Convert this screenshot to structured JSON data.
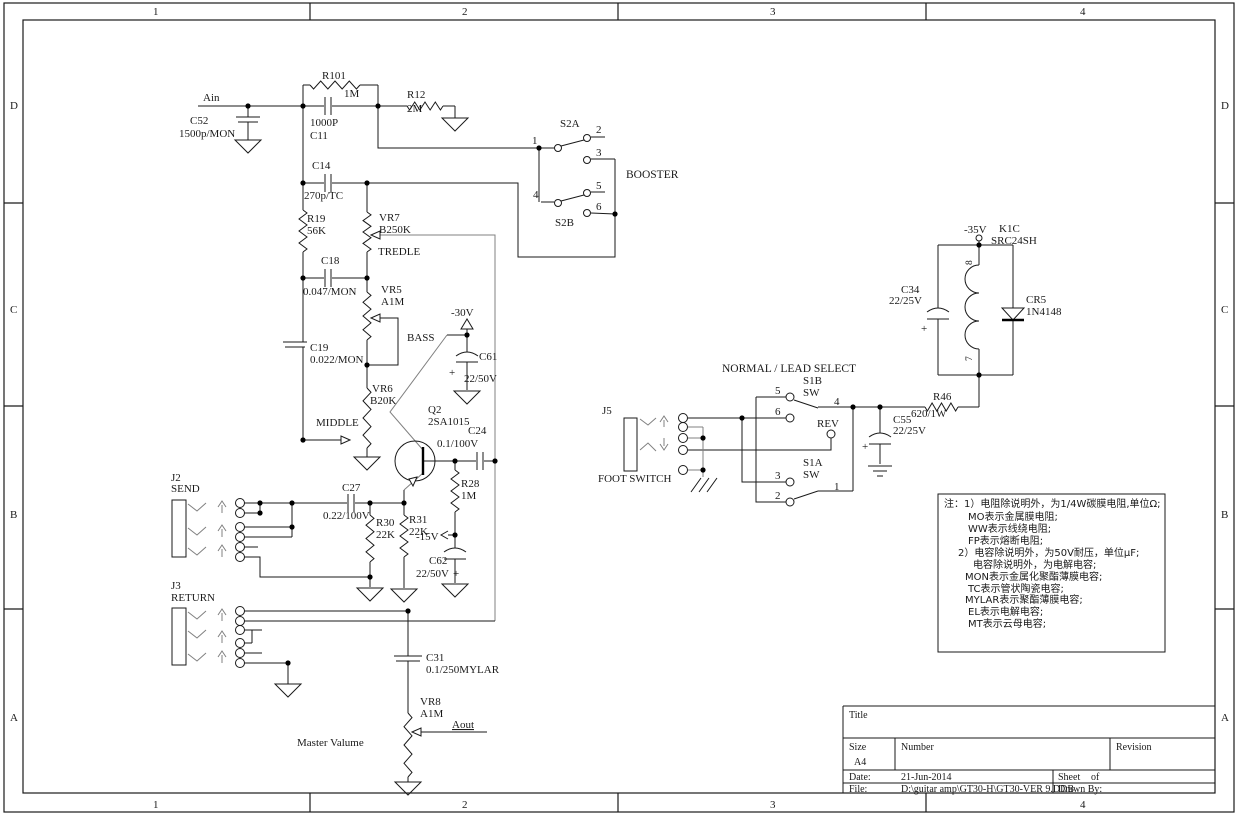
{
  "border": {
    "cols": [
      "1",
      "2",
      "3",
      "4"
    ],
    "rows": [
      "D",
      "C",
      "B",
      "A"
    ]
  },
  "labels": {
    "ain": "Ain",
    "c52_ref": "C52",
    "c52_val": "1500p/MON",
    "r101_ref": "R101",
    "r101_val": "1M",
    "c11_val": "1000P",
    "c11_ref": "C11",
    "r12_ref": "R12",
    "r12_val": "2M",
    "c14_ref": "C14",
    "c14_val": "270p/TC",
    "r19_ref": "R19",
    "r19_val": "56K",
    "vr7_ref": "VR7",
    "vr7_val": "B250K",
    "vr7_name": "TREDLE",
    "c18_ref": "C18",
    "c18_val": "0.047/MON",
    "vr5_ref": "VR5",
    "vr5_val": "A1M",
    "c19_ref": "C19",
    "c19_val": "0.022/MON",
    "vr6_ref": "VR6",
    "vr6_val": "B20K",
    "vr6_name": "MIDDLE",
    "bass": "BASS",
    "v30": "-30V",
    "c61_ref": "C61",
    "c61_val": "22/50V",
    "c61_plus": "+",
    "q2_ref": "Q2",
    "q2_val": "2SA1015",
    "c24_ref": "C24",
    "c24_val": "0.1/100V",
    "r28_ref": "R28",
    "r28_val": "1M",
    "v15": "-15V",
    "c62_ref": "C62",
    "c62_val": "22/50V",
    "c62_plus": "+",
    "r31_ref": "R31",
    "r31_val": "22K",
    "j2_ref": "J2",
    "j2_name": "SEND",
    "c27_ref": "C27",
    "c27_val": "0.22/100V",
    "r30_ref": "R30",
    "r30_val": "22K",
    "j3_ref": "J3",
    "j3_name": "RETURN",
    "c31_ref": "C31",
    "c31_val": "0.1/250MYLAR",
    "vr8_ref": "VR8",
    "vr8_val": "A1M",
    "aout": "Aout",
    "master": "Master Valume",
    "s2a": "S2A",
    "s2b": "S2B",
    "booster": "BOOSTER",
    "s2_p1": "1",
    "s2_p2": "2",
    "s2_p3": "3",
    "s2_p4": "4",
    "s2_p5": "5",
    "s2_p6": "6",
    "nls": "NORMAL / LEAD SELECT",
    "s1b_ref": "S1B",
    "s1b_sw": "SW",
    "s1a_ref": "S1A",
    "s1a_sw": "SW",
    "s1_p1": "1",
    "s1_p2": "2",
    "s1_p3": "3",
    "s1_p4": "4",
    "s1_p5": "5",
    "s1_p6": "6",
    "rev": "REV",
    "j5_ref": "J5",
    "j5_name": "FOOT SWITCH",
    "c55_ref": "C55",
    "c55_val": "22/25V",
    "c55_plus": "+",
    "r46_ref": "R46",
    "r46_val": "620/1W",
    "v35": "-35V",
    "k1c_ref": "K1C",
    "k1c_val": "SRC24SH",
    "k1c_p8": "8",
    "k1c_p7": "7",
    "c34_ref": "C34",
    "c34_val": "22/25V",
    "c34_plus": "+",
    "cr5_ref": "CR5",
    "cr5_val": "1N4148"
  },
  "notes": {
    "lines": [
      "注：1）电阻除说明外，为1/4W碳膜电阻,单位Ω;",
      "MO表示金属膜电阻;",
      "WW表示线绕电阻;",
      "FP表示熔断电阻;",
      "2）电容除说明外，为50V耐压，单位μF;",
      "电容除说明外，为电解电容;",
      "MON表示金属化聚酯薄膜电容;",
      "TC表示管状陶瓷电容;",
      "MYLAR表示聚酯薄膜电容;",
      "EL表示电解电容;",
      "MT表示云母电容;"
    ]
  },
  "titleblock": {
    "title_label": "Title",
    "size_label": "Size",
    "size_value": "A4",
    "number_label": "Number",
    "revision_label": "Revision",
    "date_label": "Date:",
    "date_value": "21-Jun-2014",
    "sheet_label": "Sheet",
    "of_label": "of",
    "file_label": "File:",
    "file_value": "D:\\guitar amp\\GT30-H\\GT30-VER 9.DDB",
    "drawnby_label": "Drawn By:"
  }
}
